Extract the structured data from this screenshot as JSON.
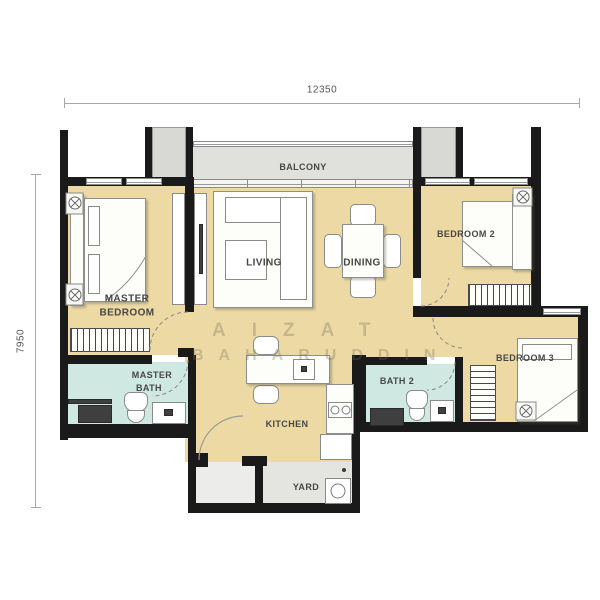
{
  "dimensions": {
    "width_label": "12350",
    "height_label": "7950"
  },
  "rooms": {
    "balcony": "BALCONY",
    "living": "LIVING",
    "dining": "DINING",
    "master_bedroom_line1": "MASTER",
    "master_bedroom_line2": "BEDROOM",
    "bedroom2": "BEDROOM 2",
    "bedroom3": "BEDROOM 3",
    "master_bath_line1": "MASTER",
    "master_bath_line2": "BATH",
    "bath2": "BATH 2",
    "kitchen": "KITCHEN",
    "yard": "YARD"
  },
  "watermark": {
    "line1": "AIZAT",
    "line2": "BAHARUDDIN"
  },
  "colors": {
    "floor_beige": "#ecd9a3",
    "bath_floor": "#cfe8e1",
    "balcony_floor": "#e0e0dd",
    "yard_floor": "#e4e4e1",
    "foyer_floor": "#ececea",
    "wall": "#1a1a1a"
  }
}
